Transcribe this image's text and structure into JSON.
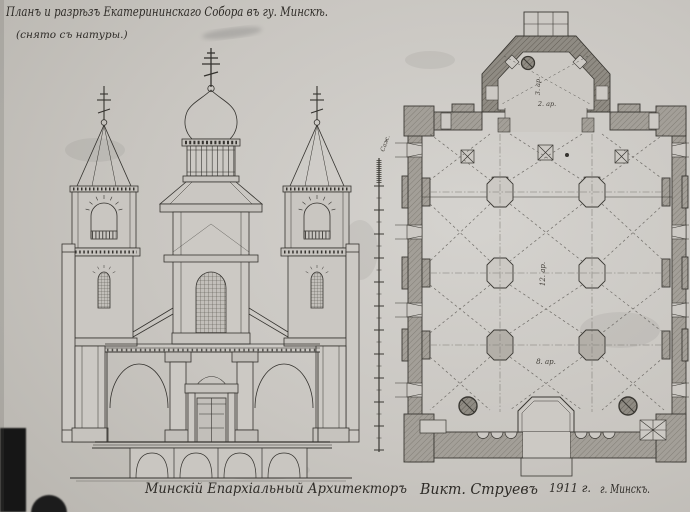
{
  "sheet": {
    "title": "Планъ и разрѣзъ Екатерининскаго Собора въ гу. Минскѣ.",
    "subtitle": "(снято съ натуры.)",
    "signature": {
      "role": "Минскій Епархіальный Архитекторъ",
      "name": "Викт. Струевъ",
      "year": "1911 г.",
      "place": "г. Минскъ."
    }
  },
  "plan": {
    "labels": {
      "apse_width": "3. ар.",
      "apse_depth": "2. ар.",
      "nave_length": "12. ар.",
      "nave_width": "8. ар."
    }
  },
  "scale_bar": {
    "unit": "Саж."
  },
  "colors": {
    "paper": "#cbc8c3",
    "ink": "#35332f",
    "wall_fill": "#a39f98",
    "apse_fill": "#918d85",
    "artifact_black": "#141414"
  }
}
